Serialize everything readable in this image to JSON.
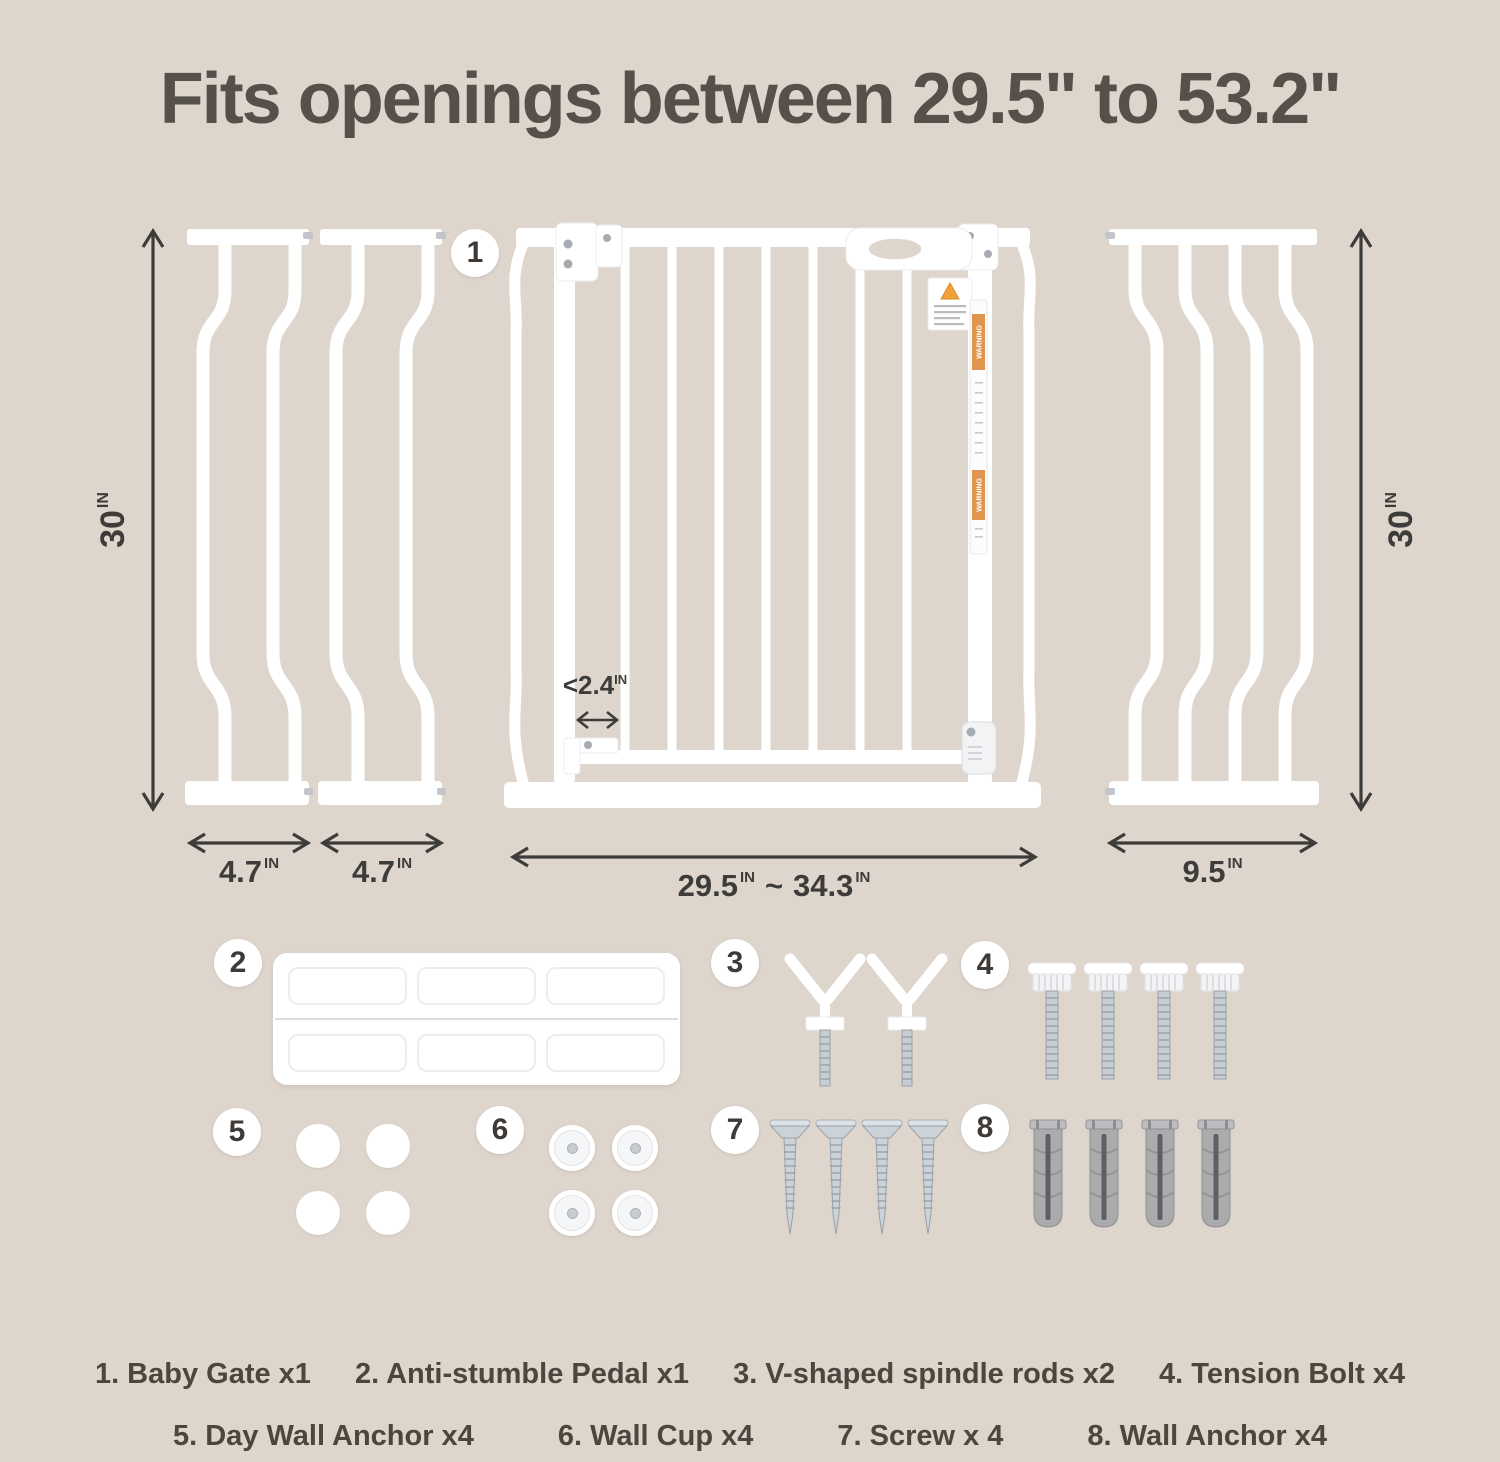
{
  "title": "Fits openings between 29.5\" to 53.2\"",
  "diagram": {
    "gate_badge": "1",
    "left_height": {
      "value": "30",
      "unit": "IN"
    },
    "right_height": {
      "value": "30",
      "unit": "IN"
    },
    "ext_left_a_width": {
      "value": "4.7",
      "unit": "IN"
    },
    "ext_left_b_width": {
      "value": "4.7",
      "unit": "IN"
    },
    "gate_width": {
      "min": "29.5",
      "separator": "~",
      "max": "34.3",
      "unit": "IN"
    },
    "ext_right_width": {
      "value": "9.5",
      "unit": "IN"
    },
    "bar_gap": {
      "value": "<2.4",
      "unit": "IN"
    },
    "warning_text": "WARNING"
  },
  "parts": {
    "pedal_badge": "2",
    "spindle_badge": "3",
    "tension_badge": "4",
    "day_anchor_badge": "5",
    "wall_cup_badge": "6",
    "screw_badge": "7",
    "wall_anchor_badge": "8"
  },
  "legend": {
    "row1": [
      "1. Baby Gate x1",
      "2. Anti-stumble Pedal x1",
      "3. V-shaped spindle rods x2",
      "4. Tension Bolt x4"
    ],
    "row2": [
      "5. Day Wall Anchor x4",
      "6. Wall Cup x4",
      "7. Screw x 4",
      "8. Wall Anchor x4"
    ]
  },
  "colors": {
    "background": "#ded5cc",
    "title_text": "#55504a",
    "dimension_text": "#3d3c3a",
    "warning_orange": "#e0954f",
    "metal": "#c6cdd3",
    "anchor_gray": "#ababae"
  }
}
